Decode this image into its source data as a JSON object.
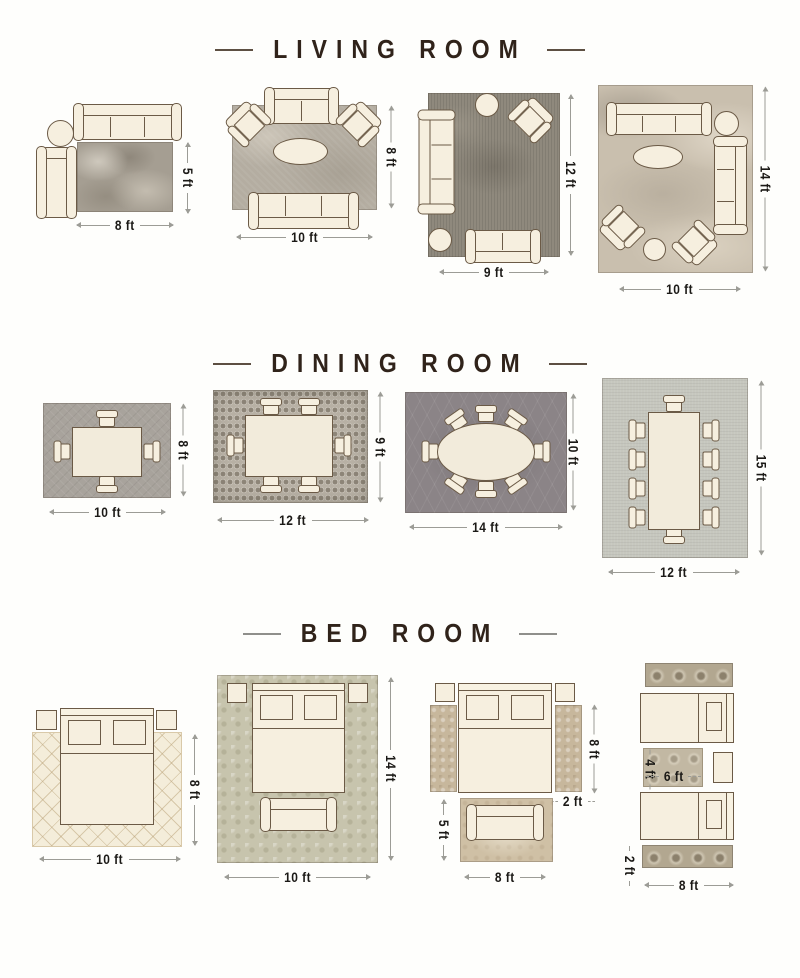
{
  "page": {
    "background": "#ffffff"
  },
  "colors": {
    "title_text": "#30231a",
    "title_dash_dark": "#5d4f42",
    "title_dash_gray": "#8f8f8b",
    "furniture_fill": "#f6efdf",
    "furniture_outline": "#6b5a46",
    "dimension_text": "#1b1916",
    "dimension_line": "#9c9c96",
    "rug_mottled_gray": "#a59e92",
    "rug_taupe": "#b4ada1",
    "rug_dark_speckled": "#8f897d",
    "rug_beige_abstract": "#c9bfae",
    "rug_dining_gray": "#a8a39c",
    "rug_mosaic": "#b7b0a4",
    "rug_charcoal_trellis": "#8b8487",
    "rug_light_sage": "#c6c7be",
    "rug_cream_diamond": "#f4edda",
    "rug_sage_damask": "#c7c4ad",
    "rug_tan_runner": "#c7b79c",
    "rug_ornate_taupe": "#b2a790"
  },
  "sections": [
    {
      "title": "LIVING ROOM",
      "layouts": [
        {
          "labels": {
            "width": "8 ft",
            "height": "5 ft"
          },
          "furniture": [
            "3-seat sofa",
            "round side table",
            "chaise",
            "area rug"
          ]
        },
        {
          "labels": {
            "width": "10 ft",
            "height": "8 ft"
          },
          "furniture": [
            "loveseat",
            "2 angled armchairs",
            "oval coffee table",
            "3-seat sofa",
            "area rug"
          ]
        },
        {
          "labels": {
            "width": "9 ft",
            "height": "12 ft"
          },
          "furniture": [
            "3-seat sofa",
            "round side table",
            "angled armchair",
            "round side table",
            "loveseat",
            "area rug"
          ]
        },
        {
          "labels": {
            "width": "10 ft",
            "height": "14 ft"
          },
          "furniture": [
            "3-seat sofa",
            "round side table",
            "oval coffee table",
            "3-seat sofa",
            "2 angled armchairs",
            "round side table",
            "area rug"
          ]
        }
      ]
    },
    {
      "title": "DINING ROOM",
      "layouts": [
        {
          "labels": {
            "width": "10 ft",
            "height": "8 ft"
          },
          "furniture": [
            "dining table",
            "4 chairs",
            "area rug"
          ]
        },
        {
          "labels": {
            "width": "12 ft",
            "height": "9 ft"
          },
          "furniture": [
            "dining table",
            "6 chairs",
            "mosaic rug"
          ]
        },
        {
          "labels": {
            "width": "14 ft",
            "height": "10 ft"
          },
          "furniture": [
            "oval dining table",
            "8 chairs",
            "trellis rug"
          ]
        },
        {
          "labels": {
            "width": "12 ft",
            "height": "15 ft"
          },
          "furniture": [
            "long dining table",
            "10 chairs",
            "area rug"
          ]
        }
      ]
    },
    {
      "title": "BED ROOM",
      "layouts": [
        {
          "labels": {
            "width": "10 ft",
            "height": "8 ft"
          },
          "furniture": [
            "bed",
            "2 nightstands",
            "diamond-pattern rug"
          ]
        },
        {
          "labels": {
            "width": "10 ft",
            "height": "14 ft"
          },
          "furniture": [
            "bed",
            "2 nightstands",
            "bench",
            "damask rug"
          ]
        },
        {
          "labels": {
            "runner_height": "8 ft",
            "runner_width": "2 ft",
            "foot_rug_height": "5 ft",
            "foot_rug_width": "8 ft"
          },
          "furniture": [
            "bed",
            "2 nightstands",
            "2 side runner rugs",
            "foot rug",
            "bench"
          ]
        },
        {
          "labels": {
            "mid_rug_height": "4 ft",
            "mid_rug_width": "6 ft",
            "runner_height": "2 ft",
            "runner_width": "8 ft"
          },
          "furniture": [
            "2 twin beds",
            "nightstand",
            "2 runner rugs",
            "between-beds rug"
          ]
        }
      ]
    }
  ]
}
